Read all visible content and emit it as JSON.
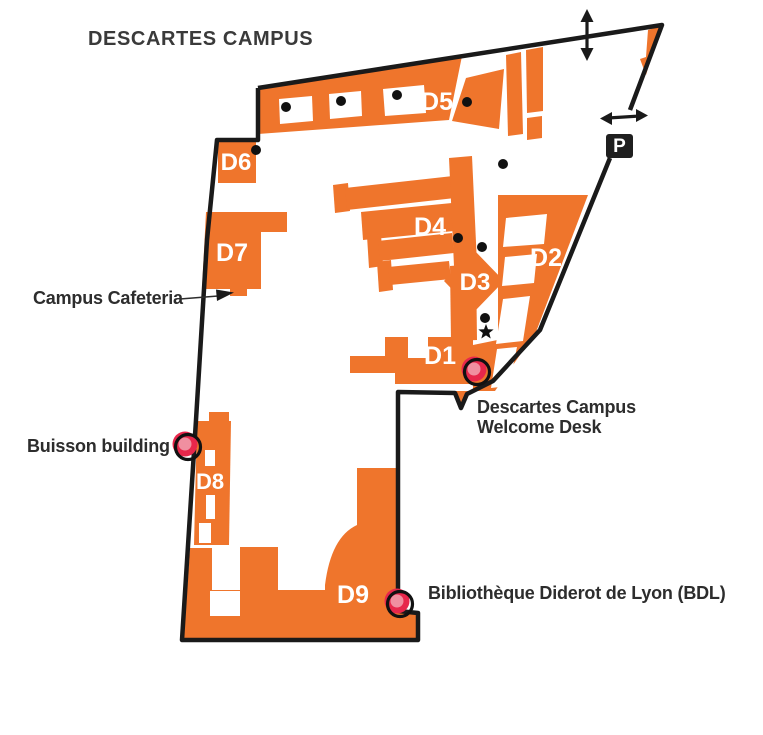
{
  "title": "DESCARTES CAMPUS",
  "parking_label": "P",
  "buildings": [
    {
      "label": "D1"
    },
    {
      "label": "D2"
    },
    {
      "label": "D3"
    },
    {
      "label": "D4"
    },
    {
      "label": "D5"
    },
    {
      "label": "D6"
    },
    {
      "label": "D7"
    },
    {
      "label": "D8"
    },
    {
      "label": "D9"
    }
  ],
  "annotations": {
    "cafeteria": "Campus Cafeteria",
    "buisson": "Buisson building",
    "welcome_line1": "Descartes Campus",
    "welcome_line2": "Welcome Desk",
    "library": "Bibliothèque Diderot de Lyon (BDL)"
  },
  "colors": {
    "building_orange": "#EF752C",
    "outline_black": "#1A1A1A",
    "marker_red": "#E7274B",
    "marker_pink": "#F08FA0",
    "annotation_text": "#2D2D2D",
    "title_text": "#3A3A3A",
    "building_label": "#FFFFFF"
  }
}
